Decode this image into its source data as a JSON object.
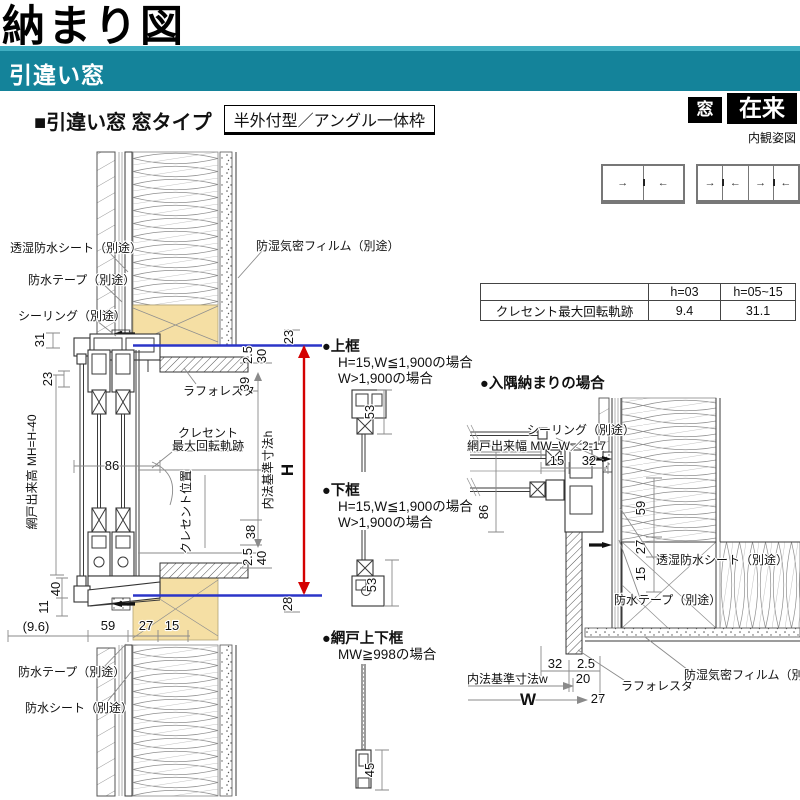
{
  "header": {
    "title": "納まり図",
    "band_label": "引違い窓",
    "section_heading": "■引違い窓 窓タイプ",
    "section_tag": "半外付型／アングル一体枠",
    "badge_window": "窓",
    "badge_zairai": "在来",
    "elevation_caption": "内観姿図"
  },
  "elevations": {
    "win2_arrows": [
      "→",
      "←"
    ],
    "win4_arrows": [
      "→",
      "←",
      "→",
      "←"
    ]
  },
  "table": {
    "header_blank": "",
    "col1": "h=03",
    "col2": "h=05~15",
    "row_label": "クレセント最大回転軌跡",
    "val1": "9.4",
    "val2": "31.1"
  },
  "vs": {
    "lbl_sheet_top": "透湿防水シート（別途）",
    "lbl_tape_top": "防水テープ（別途）",
    "lbl_sealing": "シーリング（別途）",
    "lbl_film": "防湿気密フィルム（別途）",
    "lbl_laforesta": "ラフォレスタ",
    "lbl_crescent1": "クレセント",
    "lbl_crescent2": "最大回転軌跡",
    "lbl_crescent_pos": "クレセント位置",
    "lbl_screen_h": "網戸出来高 MH=H-40",
    "lbl_inner_h": "内法基準寸法h",
    "lbl_H": "H",
    "lbl_tape_btm": "防水テープ（別途）",
    "lbl_sheet_btm": "防水シート（別途）",
    "d31": "31",
    "d23_side": "23",
    "d23_top": "23",
    "d25_top": "2.5",
    "d30": "30",
    "d39": "39",
    "d86": "86",
    "d38": "38",
    "d25_btm": "2.5",
    "d40_right": "40",
    "d28": "28",
    "d40_left": "40",
    "d11": "11",
    "d96": "(9.6)",
    "d59": "59",
    "d27": "27",
    "d15": "15"
  },
  "details": {
    "top_title": "●上框",
    "top_line1": "H=15,W≦1,900の場合",
    "top_line2": "W>1,900の場合",
    "top_dim": "53",
    "btm_title": "●下框",
    "btm_line1": "H=15,W≦1,900の場合",
    "btm_line2": "W>1,900の場合",
    "btm_dim": "53",
    "scr_title": "●網戸上下框",
    "scr_line1": "MW≧998の場合",
    "scr_dim": "45"
  },
  "corner": {
    "title": "●入隅納まりの場合",
    "lbl_sealing": "シーリング（別途）",
    "lbl_screen_w": "網戸出来幅 MW=W／2-17",
    "lbl_sheet": "透湿防水シート（別途）",
    "lbl_tape": "防水テープ（別途）",
    "lbl_laforesta": "ラフォレスタ",
    "lbl_film": "防湿気密フィルム（別途）",
    "lbl_inner_w": "内法基準寸法w",
    "lbl_W": "W",
    "d15_top": "15",
    "d32_top": "32",
    "d86": "86",
    "d59": "59",
    "d27_mid": "27",
    "d15_mid": "15",
    "d32_btm": "32",
    "d25": "2.5",
    "d20": "20",
    "d27_btm": "27"
  },
  "colors": {
    "band": "#14839A",
    "band_stripe": "#3FAEC2",
    "badge_bg": "#000000",
    "ref_line_blue": "#2B35C8",
    "dim_red": "#D40000",
    "wood_tan": "#F5DFA4"
  }
}
